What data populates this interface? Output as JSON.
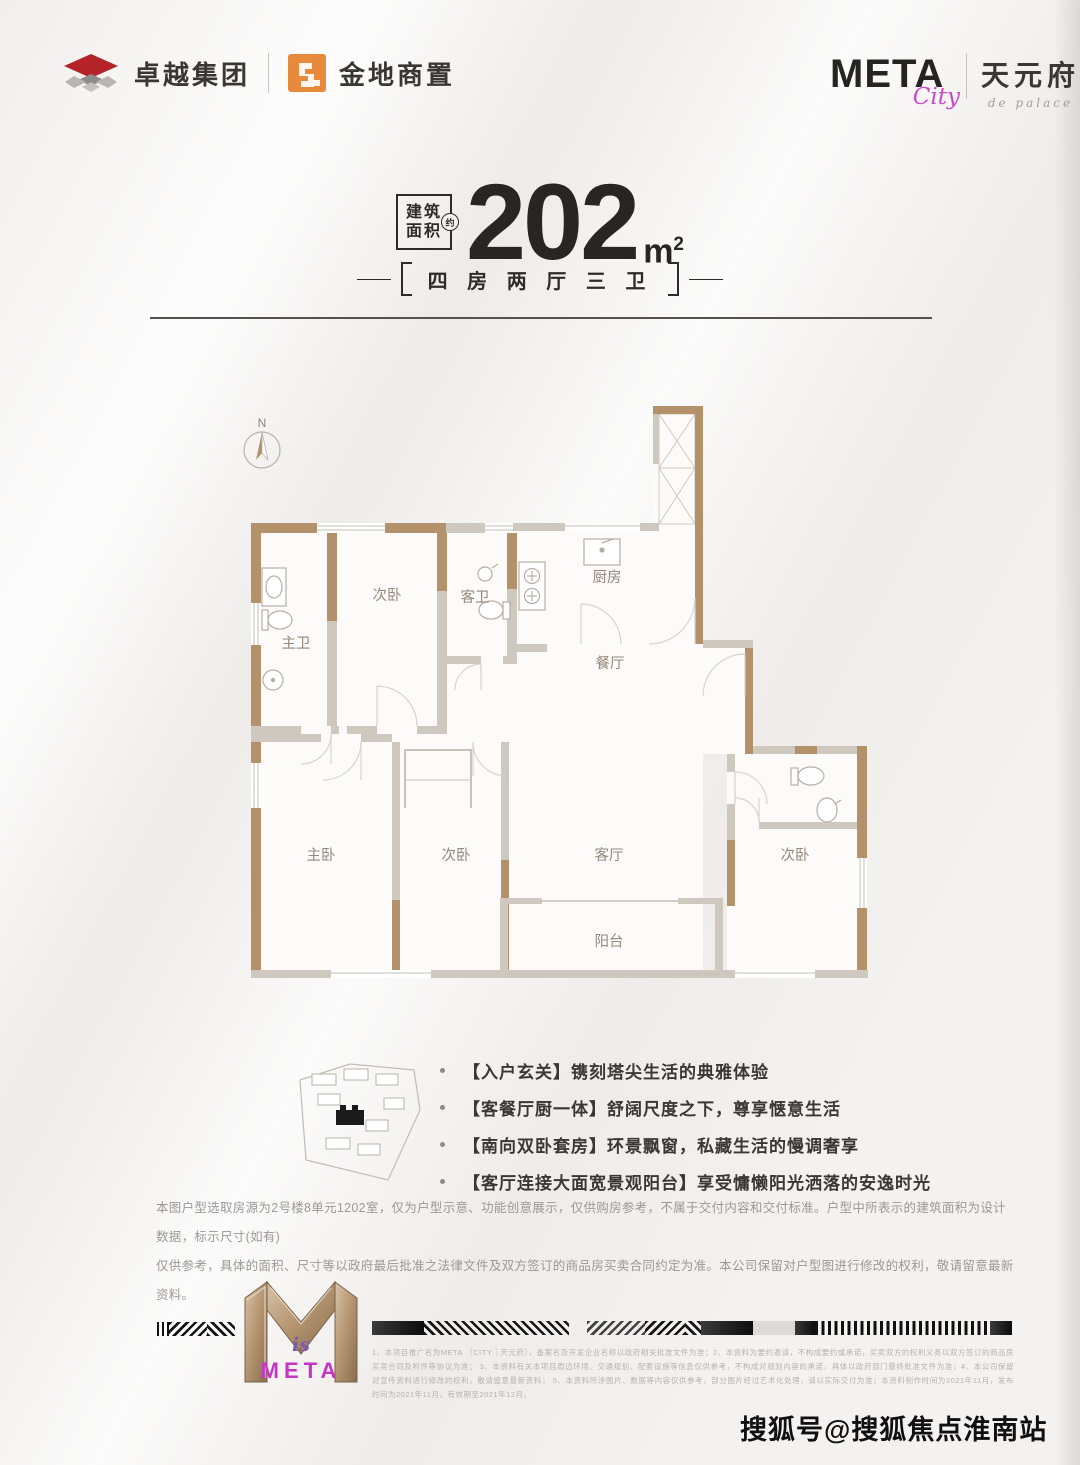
{
  "header": {
    "brand_left_1": "卓越集团",
    "brand_left_2": "金地商置",
    "brand_right_logo": "META",
    "brand_right_script": "City",
    "brand_right_name": "天元府",
    "brand_right_sub": "de palace"
  },
  "title": {
    "area_box_line1": "建筑",
    "area_box_line2": "面积",
    "area_approx": "约",
    "area_value": "202",
    "area_unit": "m",
    "area_unit_sup": "2",
    "subtitle": "四 房 两 厅 三 卫"
  },
  "floorplan": {
    "compass_label": "N",
    "rooms": [
      {
        "label": "主卫"
      },
      {
        "label": "次卧"
      },
      {
        "label": "客卫"
      },
      {
        "label": "厨房"
      },
      {
        "label": "餐厅"
      },
      {
        "label": "主卧"
      },
      {
        "label": "次卧"
      },
      {
        "label": "客厅"
      },
      {
        "label": "次卧"
      },
      {
        "label": "阳台"
      }
    ]
  },
  "features": {
    "items": [
      "【入户玄关】镌刻塔尖生活的典雅体验",
      "【客餐厅厨一体】舒阔尺度之下，尊享惬意生活",
      "【南向双卧套房】环景飘窗，私藏生活的慢调奢享",
      "【客厅连接大面宽景观阳台】享受慵懒阳光洒落的安逸时光"
    ]
  },
  "disclaimer": {
    "line1": "本图户型选取房源为2号楼8单元1202室，仅为户型示意、功能创意展示，仅供购房参考，不属于交付内容和交付标准。户型中所表示的建筑面积为设计数据，标示尺寸(如有)",
    "line2": "仅供参考，具体的面积、尺寸等以政府最后批准之法律文件及双方签订的商品房买卖合同约定为准。本公司保留对户型图进行修改的权利，敬请留意最新资料。"
  },
  "footer": {
    "logo_is": "is",
    "logo_meta": "META",
    "legal_lines": [
      "1、本项目推广名为META （CITY｜天元府），备案名及开发企业名称以政府相关批准文件为准；2、本资料为要约邀请，不构成要约或承诺，买卖双方的权利义务以双方签订的商品房买卖合同及附件等协议为准；",
      "3、本资料有关本项目周边环境、交通规划、配套设施等信息仅供参考，不构成对规划内容的承诺，具体以政府部门最终批准文件为准；4、本公司保留对宣传资料进行修改的权利，敬请留意最新资料；",
      "5、本资料所涉图片、数据等内容仅供参考，部分图片经过艺术化处理，请以实际交付为准；本资料制作时间为2021年11月，发布时间为2021年11月，有效期至2021年12月。"
    ]
  },
  "watermark": "搜狐号@搜狐焦点淮南站",
  "colors": {
    "wall_gold": "#b3916a",
    "wall_light": "#cfc8bf",
    "magenta": "#c437c4",
    "brand_red": "#b5232a",
    "brand_orange": "#e78a3c"
  }
}
